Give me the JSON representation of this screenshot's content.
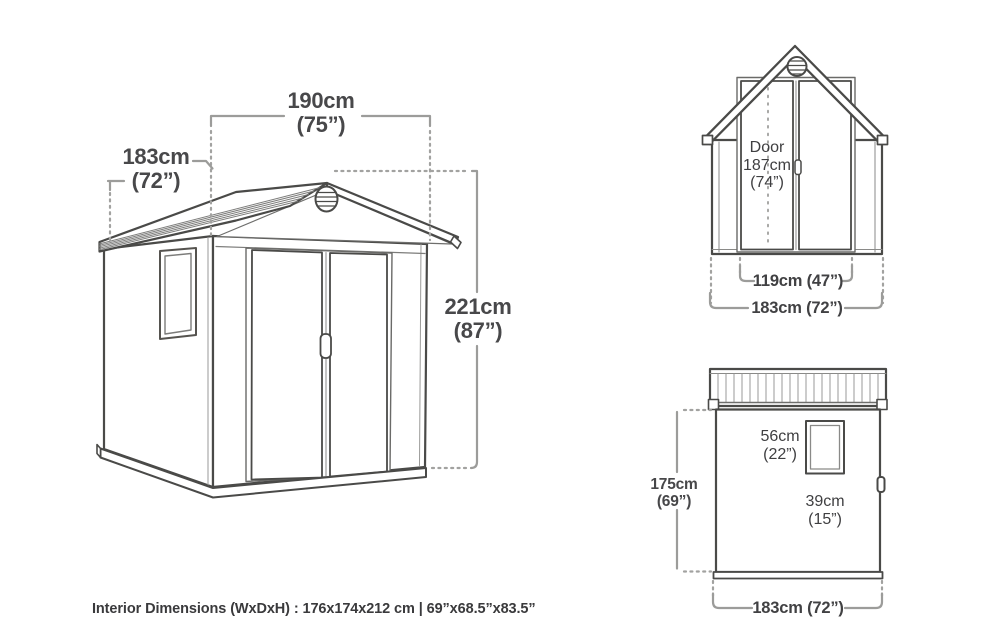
{
  "colors": {
    "page_bg": "#ffffff",
    "ink_dark": "#4a4a48",
    "ink_mid": "#8a8a88",
    "dimension_gray": "#9c9c9a",
    "text_dark": "#454547"
  },
  "main": {
    "width_cm": "190cm",
    "width_in": "(75”)",
    "depth_cm": "183cm",
    "depth_in": "(72”)",
    "height_cm": "221cm",
    "height_in": "(87”)"
  },
  "front": {
    "door_line1": "Door",
    "door_line2": "187cm",
    "door_line3": "(74”)",
    "door_width": "119cm (47”)",
    "overall_width": "183cm (72”)"
  },
  "side": {
    "window_w_cm": "56cm",
    "window_w_in": "(22”)",
    "window_h_cm": "39cm",
    "window_h_in": "(15”)",
    "height_cm": "175cm",
    "height_in": "(69”)",
    "overall_depth": "183cm (72”)"
  },
  "footer": {
    "interior_dimensions": "Interior Dimensions (WxDxH) : 176x174x212 cm | 69”x68.5”x83.5”"
  }
}
